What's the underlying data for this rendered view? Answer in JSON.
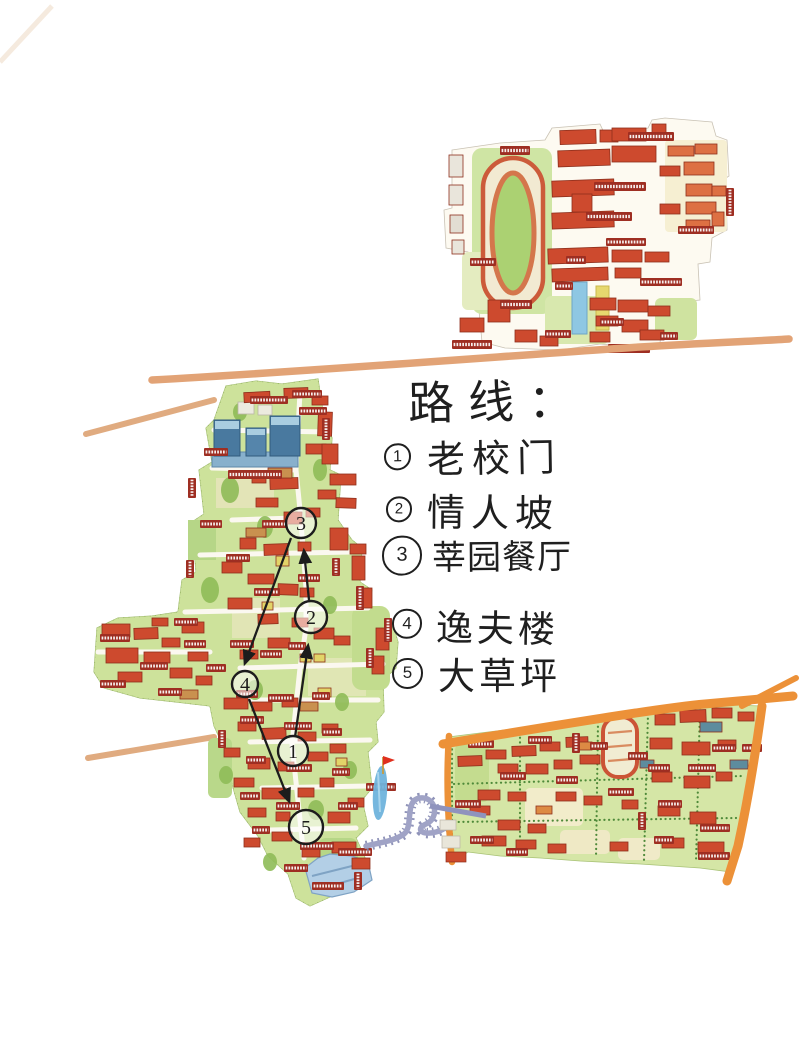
{
  "route_panel": {
    "title": "路线：",
    "items": [
      {
        "num": "1",
        "label": "老校门"
      },
      {
        "num": "2",
        "label": "情人坡"
      },
      {
        "num": "3",
        "label": "莘园餐厅"
      },
      {
        "num": "4",
        "label": "逸夫楼"
      },
      {
        "num": "5",
        "label": "大草坪"
      }
    ]
  },
  "map": {
    "markers": [
      {
        "num": "1"
      },
      {
        "num": "2"
      },
      {
        "num": "3"
      },
      {
        "num": "4"
      },
      {
        "num": "5"
      }
    ]
  },
  "colors": {
    "building_red": "#cd4a2e",
    "label_tag_red": "#9e2e22",
    "lawn_green": "#cde29b",
    "road_sand": "#e2a376",
    "road_orange": "#ec9138",
    "water_blue": "#6fb3dc",
    "bridge_purple": "#9a9dc4",
    "blue_building": "#49799f",
    "ink": "#1f1f1f"
  }
}
